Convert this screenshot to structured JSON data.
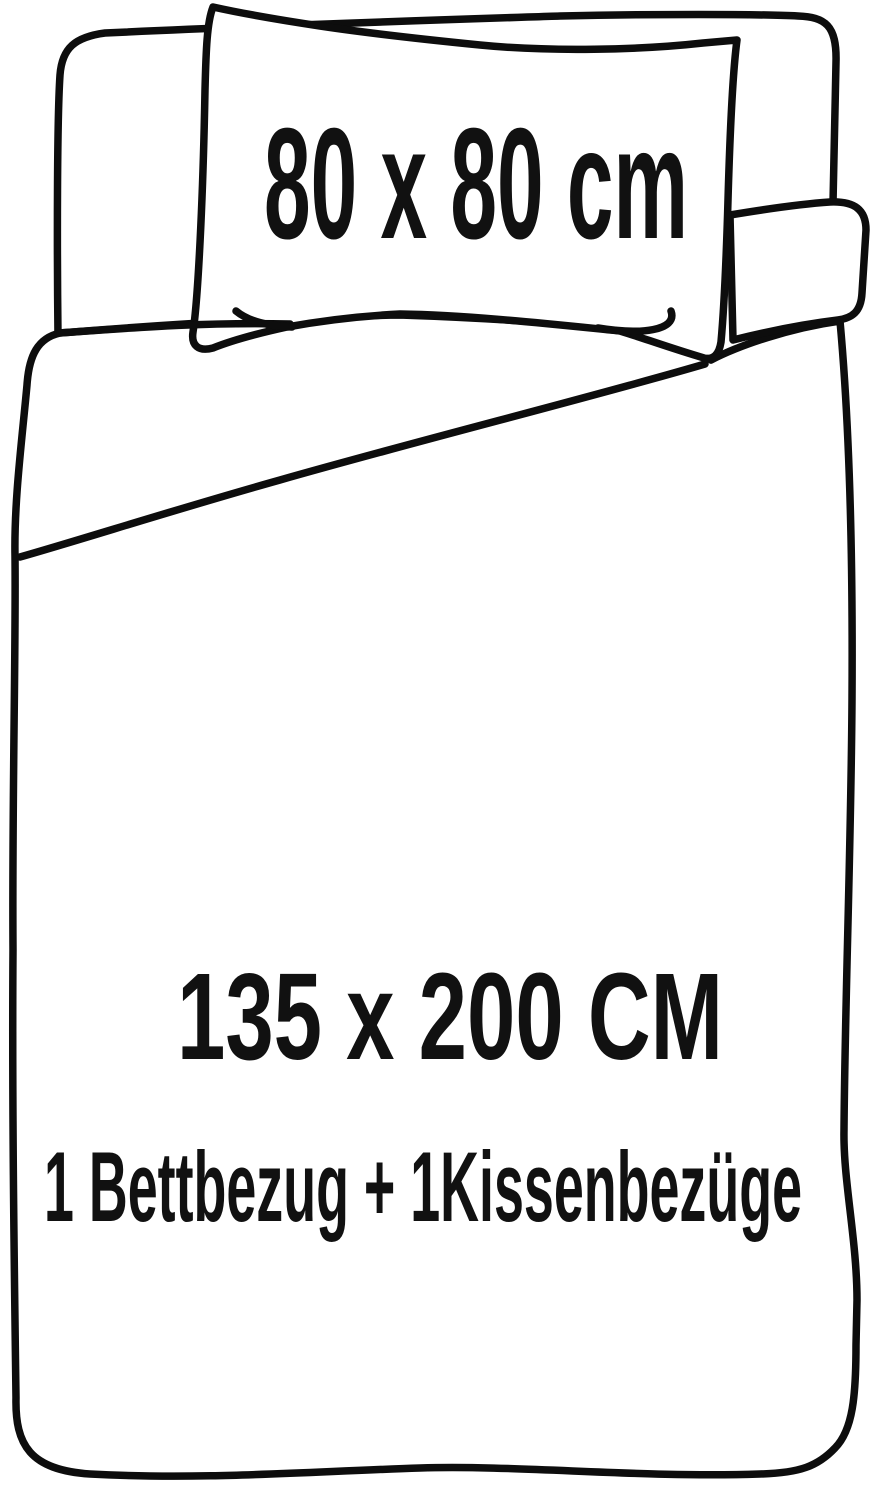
{
  "figure": {
    "type": "bedding-set-dimension-diagram",
    "background_color": "#ffffff",
    "line_color": "#0d0d0d",
    "text_color": "#111111",
    "pillow": {
      "size_label": "80 x 80 cm"
    },
    "duvet": {
      "size_label": "135 x 200 CM",
      "contents_label": "1 Bettbezug + 1Kissenbezüge"
    }
  }
}
